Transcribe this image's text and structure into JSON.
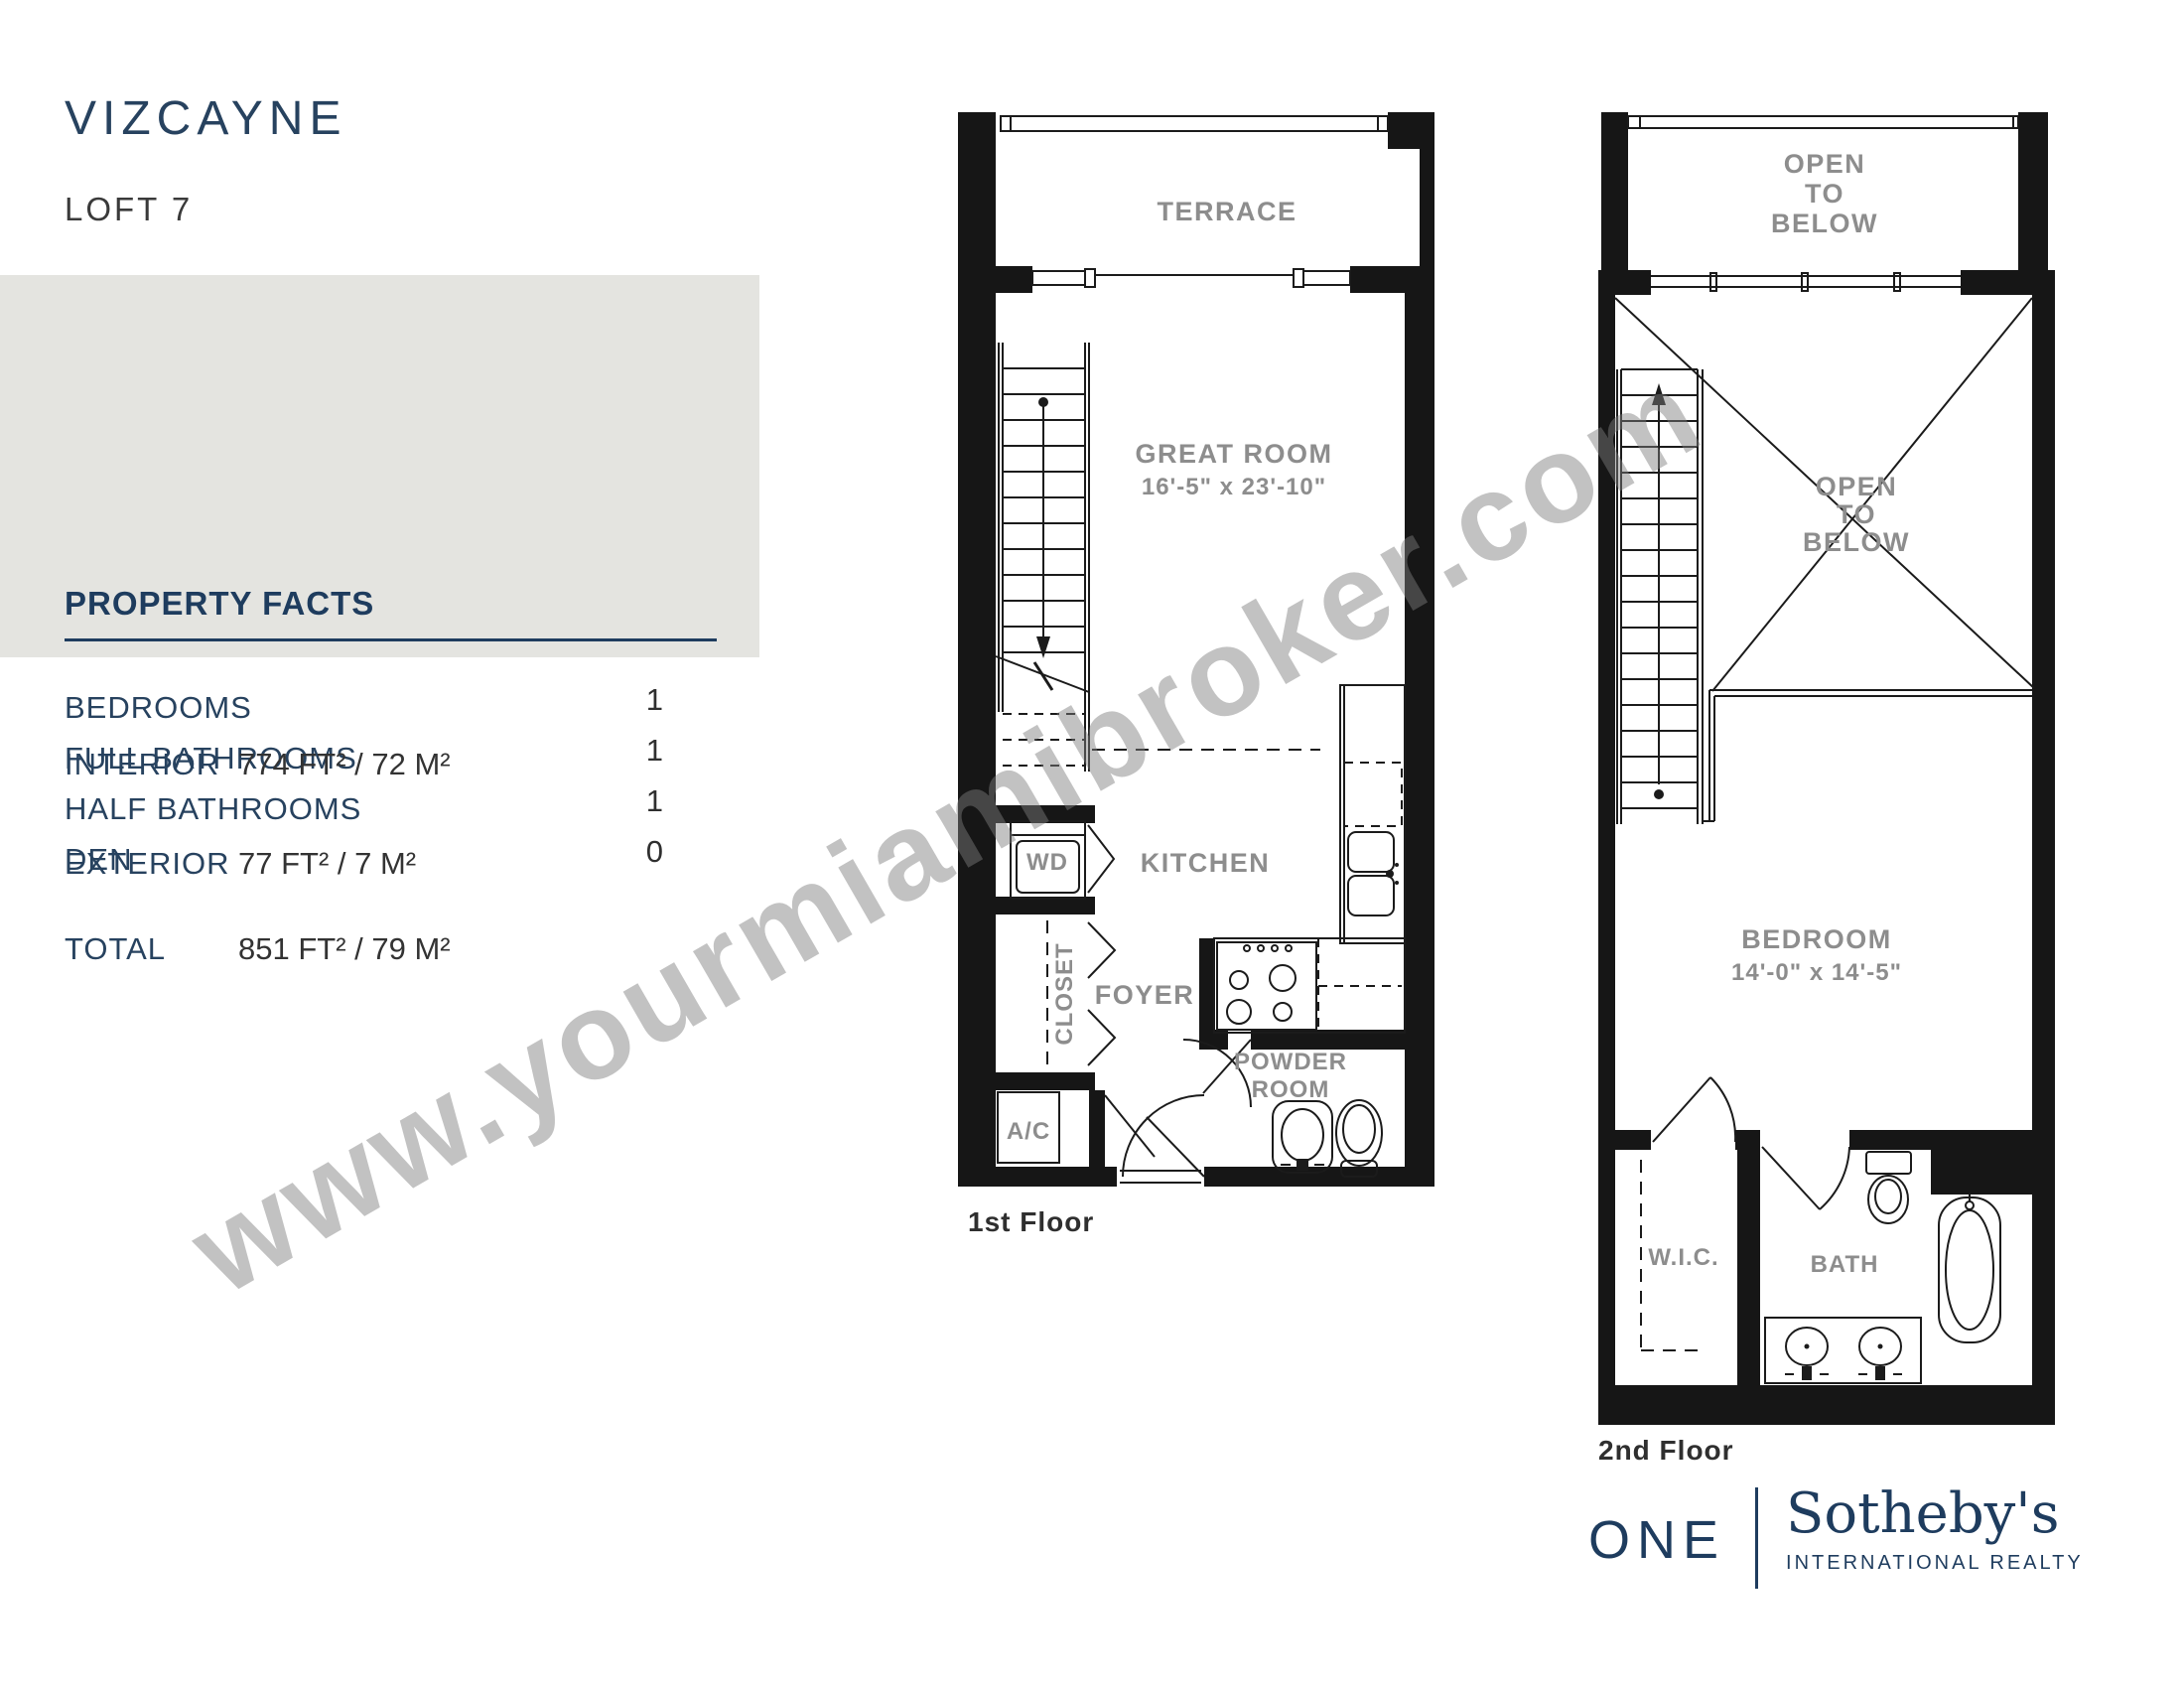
{
  "header": {
    "title": "VIZCAYNE",
    "subtitle": "LOFT 7"
  },
  "property_facts": {
    "heading": "PROPERTY FACTS",
    "rows": [
      {
        "label": "BEDROOMS",
        "value": "1"
      },
      {
        "label": "FULL BATHROOMS",
        "value": "1"
      },
      {
        "label": "HALF BATHROOMS",
        "value": "1"
      },
      {
        "label": "DEN",
        "value": "0"
      }
    ]
  },
  "areas": {
    "rows": [
      {
        "label": "INTERIOR",
        "value": "774 FT²  / 72 M²"
      },
      {
        "label": "EXTERIOR",
        "value": "77 FT²  / 7 M²"
      },
      {
        "label": "TOTAL",
        "value": "851 FT²  / 79 M²"
      }
    ]
  },
  "first_floor": {
    "caption": "1st Floor",
    "rooms": {
      "terrace": "TERRACE",
      "great_room": "GREAT ROOM",
      "great_room_dims": "16'-5\" x 23'-10\"",
      "kitchen": "KITCHEN",
      "wd": "WD",
      "closet": "CLOSET",
      "foyer": "FOYER",
      "powder_line1": "POWDER",
      "powder_line2": "ROOM",
      "ac": "A/C"
    }
  },
  "second_floor": {
    "caption": "2nd Floor",
    "rooms": {
      "open_to_below_top": [
        "OPEN",
        "TO",
        "BELOW"
      ],
      "open_to_below_mid": [
        "OPEN",
        "TO",
        "BELOW"
      ],
      "bedroom": "BEDROOM",
      "bedroom_dims": "14'-0\" x 14'-5\"",
      "wic": "W.I.C.",
      "bath": "BATH"
    }
  },
  "watermark": "www.yourmiamibroker.com",
  "logo": {
    "one": "ONE",
    "brand": "Sotheby's",
    "tagline": "INTERNATIONAL REALTY"
  },
  "colors": {
    "navy": "#1e3c5e",
    "box_gray": "#e4e4e0",
    "label_gray": "#8d8d8d",
    "line_black": "#1b1b1b"
  }
}
